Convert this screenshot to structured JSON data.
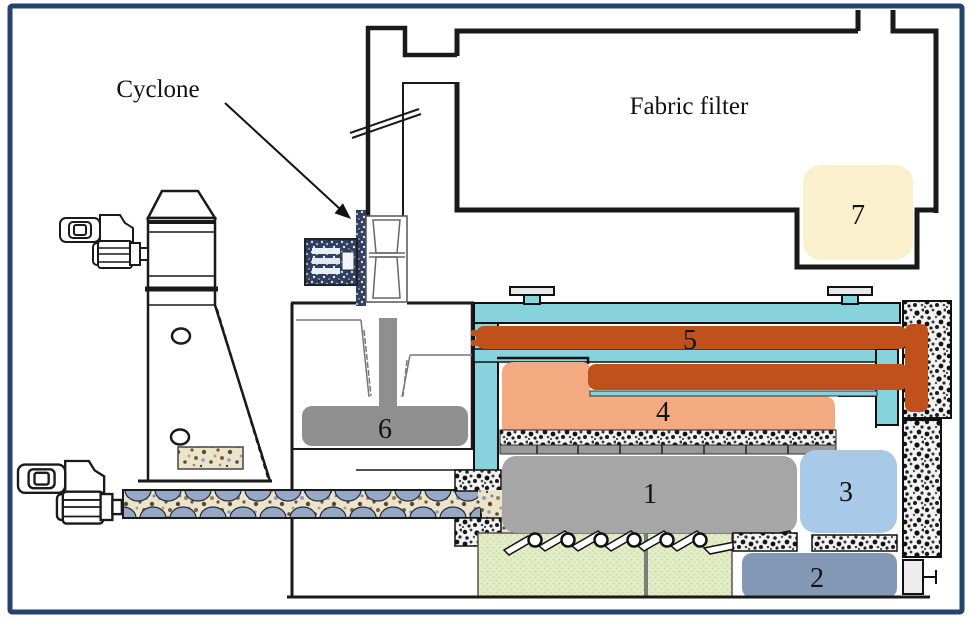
{
  "diagram": {
    "title_labels": {
      "cyclone": "Cyclone",
      "fabric_filter": "Fabric filter"
    },
    "component_numbers": {
      "n1": "1",
      "n2": "2",
      "n3": "3",
      "n4": "4",
      "n5": "5",
      "n6": "6",
      "n7": "7"
    },
    "colors": {
      "border_navy": "#26436e",
      "shell_teal": "#87d3dd",
      "heater_orange": "#c0511d",
      "zone_salmon": "#f4aa80",
      "collector_cream": "#fbf0cd",
      "body_gray": "#a6a6a6",
      "feeder_gray": "#8f8f8f",
      "box3_blue": "#a9c9e9",
      "box2_slate": "#8298b5",
      "base_green": "#e3edc9",
      "port_cap_gray": "#e9e9e9"
    }
  }
}
